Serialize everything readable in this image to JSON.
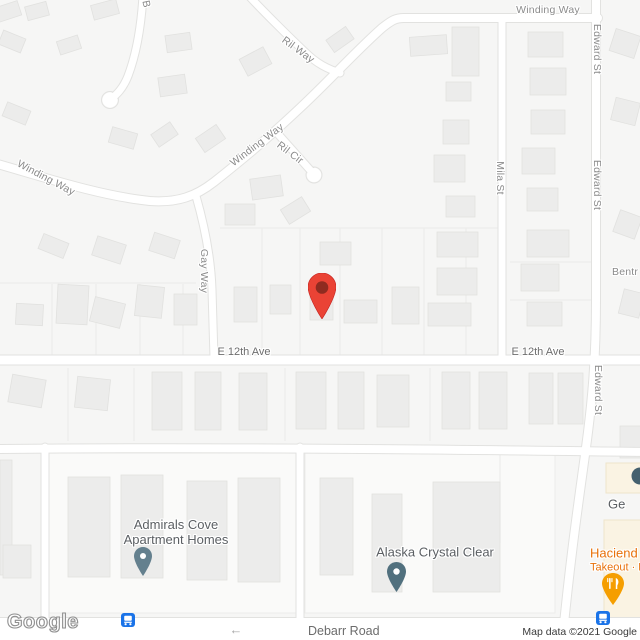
{
  "map": {
    "streets": {
      "winding_way": "Winding Way",
      "ril_way": "Ril Way",
      "ril_cir": "Ril Cir",
      "b_street_partial": "B",
      "gay_way": "Gay Way",
      "mila_st": "Mila St",
      "edward_st": "Edward St",
      "e_12th_ave": "E 12th Ave",
      "bentree_partial": "Bentr",
      "debarr_road": "Debarr Road"
    },
    "places": {
      "admirals_cove": {
        "line1": "Admirals Cove",
        "line2": "Apartment Homes",
        "pin_color": "#64808E"
      },
      "alaska_crystal_clear": {
        "name": "Alaska Crystal Clear",
        "pin_color": "#51707E"
      },
      "hacienda": {
        "name_partial": "Haciend",
        "details_partial": "Takeout · D",
        "label_color": "#E8710A",
        "pin_color": "#F59E00"
      },
      "ge_place": {
        "name_partial": "Ge",
        "icon_color": "#44606E"
      }
    },
    "marker": {
      "color": "#EA4335",
      "inner_color": "#8F2B20"
    },
    "transit_icon_color": "#1A73E8",
    "oneway_arrow_glyph": "←"
  },
  "attribution": {
    "logo": "Google",
    "copyright": "Map data ©2021 Google"
  }
}
